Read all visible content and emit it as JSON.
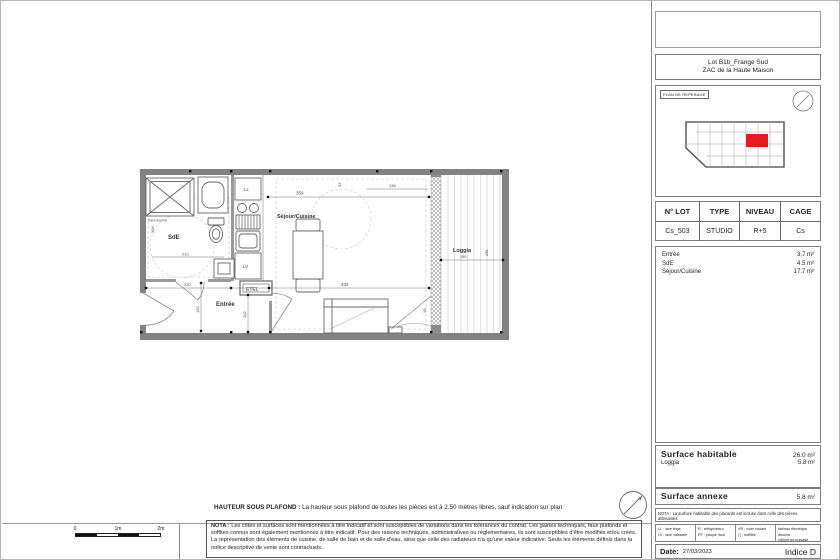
{
  "colors": {
    "highlight_red": "#e8191d",
    "wall_gray": "#828282"
  },
  "title_block": {
    "project": {
      "line1": "Lot B1b_Frange Sud",
      "line2": "ZAC de la Haute Maison"
    },
    "reperage_label": "PLAN DE REPERAGE",
    "lot_table": {
      "headers": [
        "N° LOT",
        "TYPE",
        "NIVEAU",
        "CAGE"
      ],
      "values": [
        "Cs_503",
        "STUDIO",
        "R+5",
        "Cs"
      ]
    },
    "rooms": [
      {
        "name": "Entrée",
        "area": "3.7 m²"
      },
      {
        "name": "SdE",
        "area": "4.5 m²"
      },
      {
        "name": "Séjour/Cuisine",
        "area": "17.7 m²"
      }
    ],
    "surface_habitable": {
      "label": "Surface habitable",
      "value": "26.0 m²",
      "rows": [
        {
          "name": "Loggia",
          "value": "5.8 m²"
        }
      ]
    },
    "surface_annexe": {
      "label": "Surface annexe",
      "value": "5.8 m²"
    },
    "nota": "NOTA : La surface habitable des placards est incluse dans celle des pièces attenantes",
    "legend": {
      "cells": [
        [
          "LL : lave linge",
          "LV : lave vaisselle"
        ],
        [
          "R : réfrigérateur",
          "PF : plaque /four"
        ],
        [
          "VR : volet roulant",
          "[ ] : soffites"
        ],
        [
          "tableau électrique abonné",
          "robinet de puisage"
        ]
      ]
    },
    "date_label": "Date:",
    "date_value": "27/03/2023",
    "indice": "Indice D"
  },
  "plan": {
    "labels": {
      "sde": "SdE",
      "entree": "Entrée",
      "sejour": "Séjour/Cuisine",
      "loggia": "Loggia",
      "etel": "ETEL",
      "ll": "LL",
      "lv": "LV",
      "vr": "VR",
      "pare_douche": "Pare-douche"
    },
    "dims": {
      "sejour_top": "359",
      "sejour_top_right": "136",
      "facade_top": "52",
      "sde_height": "206",
      "sde_width": "210",
      "entree_width": "230",
      "entree_left": "132",
      "entree_right": "102",
      "sejour_bottom": "402",
      "loggia_width": "150",
      "loggia_height": "298"
    }
  },
  "footer": {
    "hauteur_label": "HAUTEUR SOUS PLAFOND :",
    "hauteur_text": "La hauteur sous plafond de toutes les pièces est à 2.50 mètres libres, sauf indication sur plan",
    "nota_label": "NOTA :",
    "nota_text": "Les côtes et surfaces sont mentionnées à titre indicatif et sont susceptibles de variations dans les tolérances du contrat. Les gaines techniques, faux plafonds et soffites connus sont également mentionnés à titre indicatif. Pour des raisons techniques, administratives ou réglementaires, ils sont susceptibles d'être modifiés et/ou créés. La représentation des éléments de cuisine, de salle de bain et de salle d'eau, ainsi que celle des radiateurs n'a qu'une valeur indicative. Seuls les éléments définis dans la notice descriptive de vente sont contractuels."
  },
  "scale_bar": {
    "labels": [
      "0",
      "1m",
      "2m"
    ]
  }
}
